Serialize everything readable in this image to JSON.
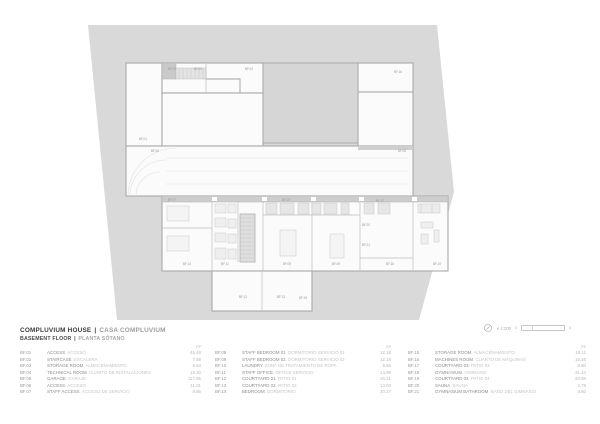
{
  "title": {
    "en": "COMPLUVIUM HOUSE",
    "sep": "|",
    "es": "CASA COMPLUVIUM"
  },
  "subtitle": {
    "en": "BASEMENT FLOOR",
    "sep": "|",
    "es": "PLANTA SÓTANO"
  },
  "scale": {
    "north_icon": "north-arrow-icon",
    "label": "e 1:200",
    "bar_start": "0",
    "bar_end": "5"
  },
  "legend": {
    "unit": "m²",
    "sep": ".",
    "columns": [
      {
        "rows": [
          {
            "code": "BF.01",
            "name_en": "ACCESS",
            "name_es": "ACCESO",
            "area": "45.49"
          },
          {
            "code": "BF.02",
            "name_en": "STAIRCASE",
            "name_es": "ESCALERA",
            "area": "7.58"
          },
          {
            "code": "BF.03",
            "name_en": "STORAGE ROOM",
            "name_es": "ALMACENAMIENTO",
            "area": "6.63"
          },
          {
            "code": "BF.04",
            "name_en": "TECHNICAL ROOM",
            "name_es": "CUARTO DE INSTALACIONES",
            "area": "19.30"
          },
          {
            "code": "BF.05",
            "name_en": "GARAGE",
            "name_es": "GARAJE",
            "area": "117.85"
          },
          {
            "code": "BF.06",
            "name_en": "ACCESS",
            "name_es": "ACCESO",
            "area": "11.01"
          },
          {
            "code": "BF.07",
            "name_en": "STAFF ACCESS",
            "name_es": "ACCESO DE SERVICIO",
            "area": "8.86"
          }
        ]
      },
      {
        "rows": [
          {
            "code": "BF.08",
            "name_en": "STAFF BEDROOM 01",
            "name_es": "DORMITORIO SERVICIO 01",
            "area": "12.18"
          },
          {
            "code": "BF.09",
            "name_en": "STAFF BEDROOM 02",
            "name_es": "DORMITORIO SERVICIO 02",
            "area": "12.18"
          },
          {
            "code": "BF.10",
            "name_en": "LAUNDRY",
            "name_es": "ZONA DE TRATAMIENTO DE ROPA",
            "area": "8.66"
          },
          {
            "code": "BF.11",
            "name_en": "STAFF OFFICE",
            "name_es": "OFFICE SERVICIO",
            "area": "14.99"
          },
          {
            "code": "BF.12",
            "name_en": "COURTYARD 01",
            "name_es": "PATIO 01",
            "area": "16.21"
          },
          {
            "code": "BF.13",
            "name_en": "COURTYARD 02",
            "name_es": "PATIO 02",
            "area": "13.03"
          },
          {
            "code": "BF.14",
            "name_en": "BEDROOM",
            "name_es": "DORMITORIO",
            "area": "20.27"
          }
        ]
      },
      {
        "rows": [
          {
            "code": "BF.15",
            "name_en": "STORAGE ROOM",
            "name_es": "ALMACENAMIENTO",
            "area": "18.11"
          },
          {
            "code": "BF.16",
            "name_en": "MACHINES ROOM",
            "name_es": "CUARTO DE MÁQUINAS",
            "area": "15.16"
          },
          {
            "code": "BF.17",
            "name_en": "COURTYARD 03",
            "name_es": "PATIO 03",
            "area": "8.80"
          },
          {
            "code": "BF.18",
            "name_en": "GYMNASIUM",
            "name_es": "GIMNASIO",
            "area": "31.44"
          },
          {
            "code": "BF.19",
            "name_en": "COURTYARD 04",
            "name_es": "PATIO 04",
            "area": "20.68"
          },
          {
            "code": "BF.20",
            "name_en": "SAUNA",
            "name_es": "SAUNA",
            "area": "2.78"
          },
          {
            "code": "BF.21",
            "name_en": "GYMNASIUM BATHROOM",
            "name_es": "BAÑO DEL GIMNASIO",
            "area": "4.50"
          }
        ]
      }
    ]
  },
  "plan": {
    "labels": [
      {
        "code": "BF.01",
        "x": 143,
        "y": 140
      },
      {
        "code": "BF.02",
        "x": 172,
        "y": 70
      },
      {
        "code": "BF.03",
        "x": 198,
        "y": 70
      },
      {
        "code": "BF.04",
        "x": 249,
        "y": 70
      },
      {
        "code": "BF.16",
        "x": 398,
        "y": 73
      },
      {
        "code": "BF.05",
        "x": 155,
        "y": 152
      },
      {
        "code": "BF.06",
        "x": 402,
        "y": 152
      },
      {
        "code": "BF.07",
        "x": 172,
        "y": 201
      },
      {
        "code": "BF.10",
        "x": 286,
        "y": 201
      },
      {
        "code": "BF.17",
        "x": 380,
        "y": 202
      },
      {
        "code": "BF.14",
        "x": 187,
        "y": 265
      },
      {
        "code": "BF.11",
        "x": 225,
        "y": 265
      },
      {
        "code": "BF.08",
        "x": 287,
        "y": 265
      },
      {
        "code": "BF.09",
        "x": 336,
        "y": 265
      },
      {
        "code": "BF.18",
        "x": 390,
        "y": 265
      },
      {
        "code": "BF.15",
        "x": 437,
        "y": 265
      },
      {
        "code": "BF.20",
        "x": 366,
        "y": 226
      },
      {
        "code": "BF.21",
        "x": 366,
        "y": 246
      },
      {
        "code": "BF.12",
        "x": 243,
        "y": 298
      },
      {
        "code": "BF.13",
        "x": 281,
        "y": 298
      },
      {
        "code": "BF.19",
        "x": 303,
        "y": 299
      }
    ]
  }
}
